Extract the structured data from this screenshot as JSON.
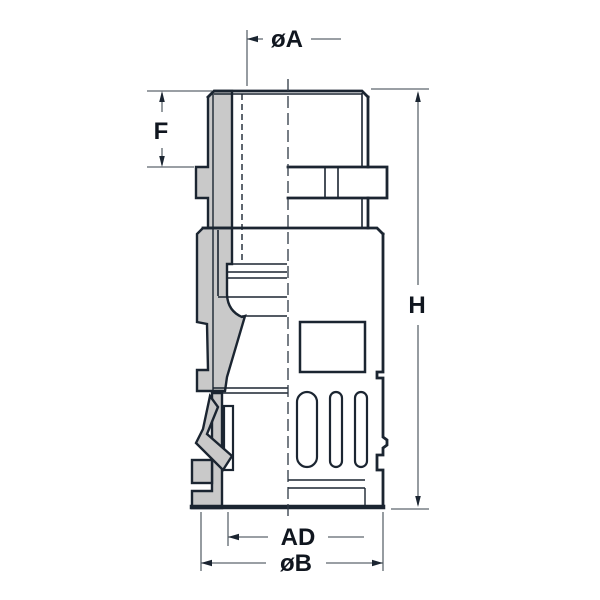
{
  "drawing": {
    "kind": "half-section technical drawing of a flexible-conduit fitting",
    "dimension_labels": {
      "top_diameter": "øA",
      "thread_length": "F",
      "overall_height": "H",
      "inner_diameter": "AD",
      "outer_diameter": "øB"
    },
    "colors": {
      "outline": "#1b2531",
      "section_fill": "#c9c9c9",
      "dimension_line": "#5d666e",
      "label_text": "#10161f",
      "accent_red": "#d91420",
      "background": "#ffffff"
    }
  }
}
